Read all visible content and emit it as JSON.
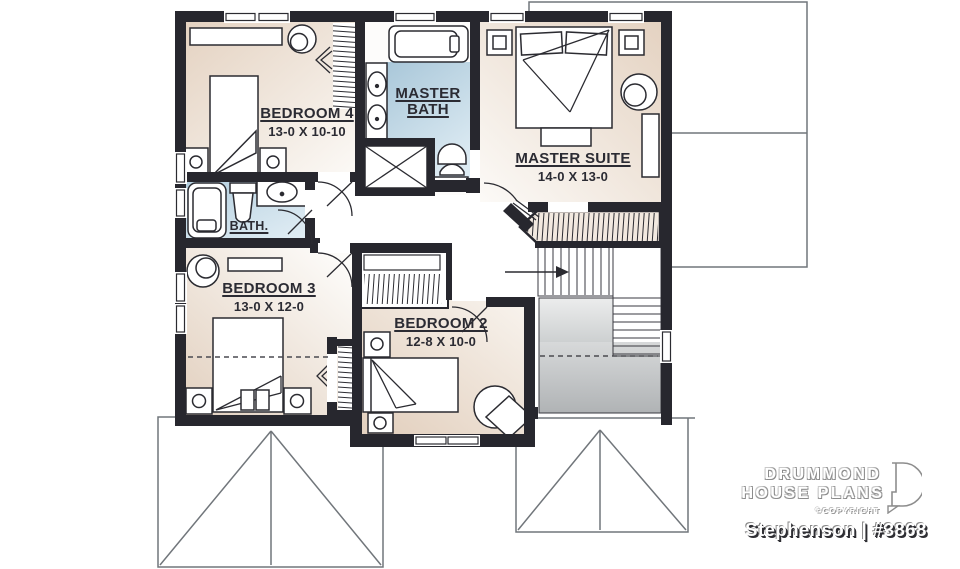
{
  "rooms": {
    "bedroom4": {
      "name": "BEDROOM 4",
      "dims": "13-0 X 10-10"
    },
    "master_bath": {
      "name": "MASTER BATH"
    },
    "master_suite": {
      "name": "MASTER SUITE",
      "dims": "14-0 X 13-0"
    },
    "bath": {
      "name": "BATH."
    },
    "bedroom3": {
      "name": "BEDROOM 3",
      "dims": "13-0 X 12-0"
    },
    "bedroom2": {
      "name": "BEDROOM 2",
      "dims": "12-8 X 10-0"
    }
  },
  "branding": {
    "brand_line1": "DRUMMOND",
    "brand_line2": "HOUSE PLANS",
    "copyright": "©COPYRIGHT",
    "plan_label": "Stephenson | #3868"
  },
  "colors": {
    "wall": "#27272e",
    "floor_beige": "#e6d4c3",
    "bath_blue": "#aecadb",
    "stair_gray": "#bcbfc1",
    "roof_line": "#71767b",
    "label_text": "#2b2b33"
  }
}
